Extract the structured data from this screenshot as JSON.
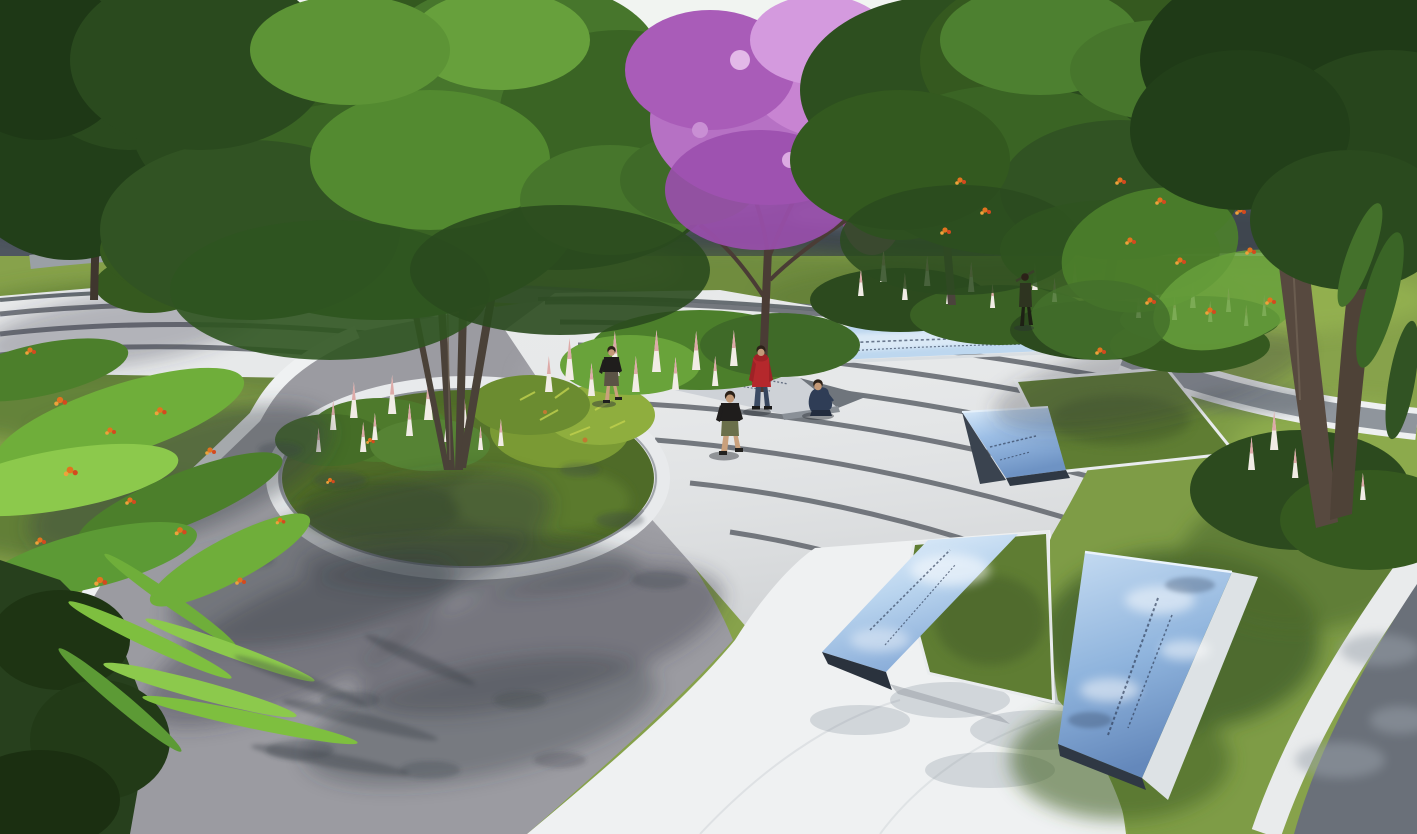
{
  "meta": {
    "description": "Photorealistic landscape-architecture rendering of a curved memorial park plaza, aerial three-quarter view, midday sun",
    "render_style": "3D visualization, no UI chrome, no legible text"
  },
  "palette": {
    "sky": "#e9efec",
    "distant_lawn": "#a2b75a",
    "sidewalk": "#d7dbda",
    "road_asphalt": "#4e565f",
    "road_curb": "#dfe3e4",
    "park_lawn": "#87a24b",
    "lawn_right": "#7e9c46",
    "lawn_shade": "#44622a",
    "plaza_concrete": "#9b9ba1",
    "plaza_shadow": "#3c4148",
    "white_paving": "#eff1f2",
    "step_tread": "#e7e9ea",
    "step_riser": "#5f646b",
    "corner_path": "#6a7079",
    "parterre_grass": "#5f7d33",
    "planter_grass": "#4f6b28",
    "planter_ring": "#e8eaec",
    "panel_blue_light": "#bdd7ef",
    "panel_blue": "#8fb4dd",
    "panel_blue_deep": "#6e93c4",
    "panel_edge_dark": "#2f3844",
    "stone_slab": "#ced2d7",
    "inscription": "#2c3b55",
    "foliage_dark": "#223f19",
    "foliage_mid": "#35591f",
    "foliage_light": "#67a03c",
    "blossom_pink": "#c884d2",
    "flame_orange": "#e2731f",
    "spike_white": "#f1ece5",
    "spike_pink": "#ddaaa8",
    "trunk_brown": "#57493f",
    "skin": "#c49a78"
  },
  "people": {
    "walker_black_tee": {
      "pose": "walking left of plaza",
      "top": "#1f1d1c",
      "shorts": "#5b5345"
    },
    "red_hoodie": {
      "pose": "standing, viewing inscription slab",
      "top": "#b5282c",
      "pants": "#3a4a63"
    },
    "boy_black_tee": {
      "pose": "walking toward viewer",
      "top": "#1f1d1c",
      "shorts": "#6a6f4a"
    },
    "crouching_child": {
      "pose": "crouching near slab",
      "outfit": "#2f3d56"
    },
    "distant_walker": {
      "pose": "walking on upper path",
      "outfit": "#2e3420"
    }
  },
  "scene": {
    "background": {
      "road": "asphalt road, horizontal, upper third",
      "beyond_road": "flat mown lawn to horizon",
      "sidewalk": "light stone verge on far side"
    },
    "signage": [
      {
        "name": "flush glass strip in upper steps",
        "material": "blue reflective glass",
        "inscription_legible": false
      },
      {
        "name": "wedge panel in mid steps beside parterre",
        "material": "blue reflective glass",
        "inscription_legible": false
      },
      {
        "name": "wedge panel on white path, center bottom",
        "material": "blue reflective glass",
        "inscription_legible": false
      },
      {
        "name": "large tilted panel in right lawn",
        "material": "blue reflective glass, white stone frame",
        "inscription_legible": false
      },
      {
        "name": "inclined stone slab near flower bed",
        "material": "light granite, engraved",
        "inscription_legible": false
      }
    ],
    "planter": {
      "shape": "ellipse in plaza",
      "contents": "multi-stem tree, white flower spikes, croton shrub, lawn",
      "edge": "white stone ring"
    },
    "steps": {
      "style": "concentric curved terraces, white treads with dark granite risers",
      "groups": 2
    },
    "vegetation": [
      "large green canopy tree center-left rising from circular planter",
      "pink flowering tree center",
      "two green canopy trees upper right",
      "dark foreground tree far right with twin trunks",
      "flame-orange flowering shrubs (left, top-left, right)",
      "magenta bougainvillea accents",
      "rows of white-pink flower spikes",
      "bright fern fronds lower left"
    ],
    "people_count": 5
  }
}
